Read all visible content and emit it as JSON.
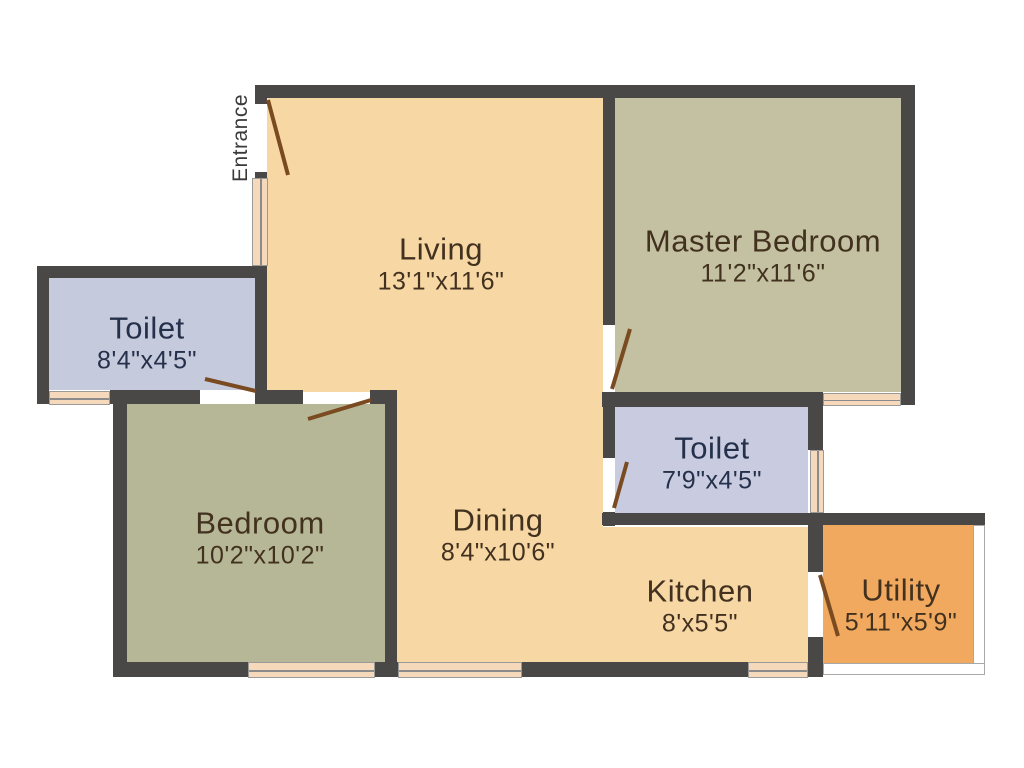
{
  "entrance": {
    "label": "Entrance"
  },
  "rooms": [
    {
      "key": "living",
      "name": "Living",
      "dims": "13'1\"x11'6\""
    },
    {
      "key": "master_bedroom",
      "name": "Master Bedroom",
      "dims": "11'2\"x11'6\""
    },
    {
      "key": "toilet_left",
      "name": "Toilet",
      "dims": "8'4\"x4'5\""
    },
    {
      "key": "bedroom",
      "name": "Bedroom",
      "dims": "10'2\"x10'2\""
    },
    {
      "key": "dining",
      "name": "Dining",
      "dims": "8'4\"x10'6\""
    },
    {
      "key": "toilet_right",
      "name": "Toilet",
      "dims": "7'9\"x4'5\""
    },
    {
      "key": "kitchen",
      "name": "Kitchen",
      "dims": "8'x5'5\""
    },
    {
      "key": "utility",
      "name": "Utility",
      "dims": "5'11\"x5'9\""
    }
  ],
  "palette": {
    "wall": "#4a4747",
    "floor_living_dining_kitchen": "#f7d8a5",
    "floor_master_bedroom": "#c3c1a1",
    "floor_bedroom": "#b6b796",
    "floor_toilet": "#c7cbdf",
    "floor_utility": "#f1a95f",
    "window_fill": "#f6d9bb",
    "door_swing": "#7a4a20",
    "label_warm": "#42311f",
    "label_cool": "#25304a"
  }
}
